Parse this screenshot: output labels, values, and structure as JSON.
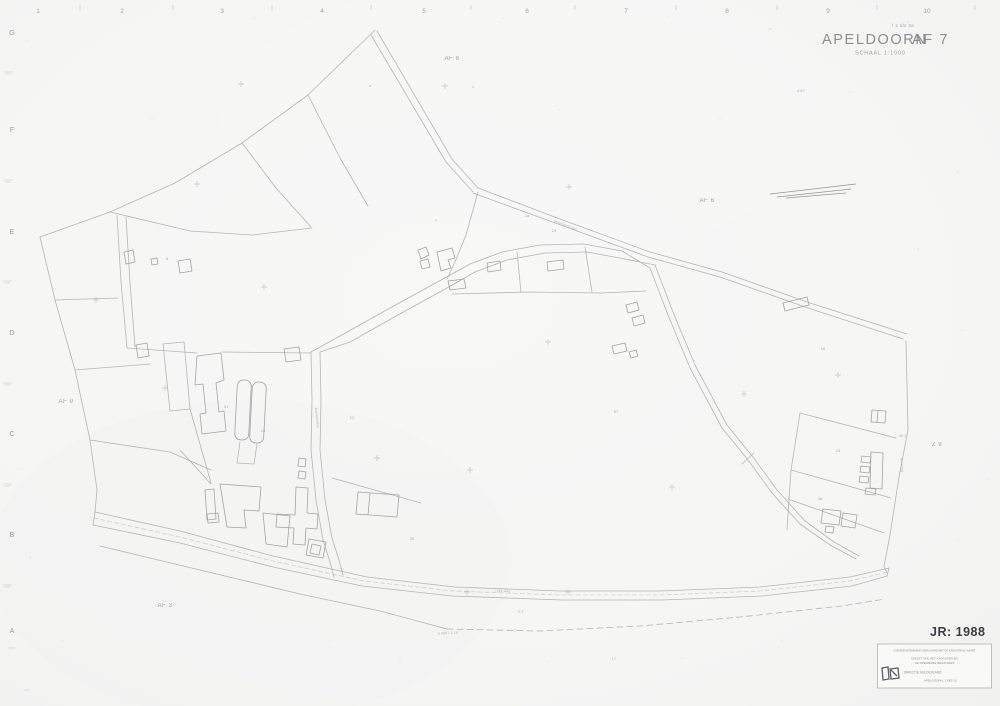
{
  "title_block": {
    "annotation": "f 1 als 3a",
    "city": "APELDOORN",
    "code": "AF 7",
    "scale": "SCHAAL  1:1000",
    "year": "JR: 1988"
  },
  "grid": {
    "top_numbers": [
      {
        "t": "1",
        "x": 38
      },
      {
        "t": "2",
        "x": 122
      },
      {
        "t": "3",
        "x": 222
      },
      {
        "t": "4",
        "x": 322
      },
      {
        "t": "5",
        "x": 424
      },
      {
        "t": "6",
        "x": 527
      },
      {
        "t": "7",
        "x": 626
      },
      {
        "t": "8",
        "x": 727
      },
      {
        "t": "9",
        "x": 828
      },
      {
        "t": "10",
        "x": 927
      }
    ],
    "left_letters": [
      {
        "t": "G",
        "y": 35
      },
      {
        "t": "F",
        "y": 132
      },
      {
        "t": "E",
        "y": 234
      },
      {
        "t": "D",
        "y": 335
      },
      {
        "t": "C",
        "y": 436
      },
      {
        "t": "B",
        "y": 537
      },
      {
        "t": "A",
        "y": 633
      }
    ]
  },
  "sheet_labels": [
    {
      "t": "AF 8",
      "x": 452,
      "y": 60
    },
    {
      "t": "AF 6",
      "x": 707,
      "y": 202
    },
    {
      "t": "AF 9",
      "x": 66,
      "y": 403
    },
    {
      "t": "AF 3",
      "x": 165,
      "y": 607
    },
    {
      "t": "Z 9",
      "x": 937,
      "y": 446
    }
  ],
  "parcel_numbers": [
    {
      "t": "4",
      "x": 370,
      "y": 87
    },
    {
      "t": "1",
      "x": 473,
      "y": 88
    },
    {
      "t": "7",
      "x": 436,
      "y": 222
    },
    {
      "t": "1a",
      "x": 527,
      "y": 217
    },
    {
      "t": "29",
      "x": 554,
      "y": 232
    },
    {
      "t": "18",
      "x": 823,
      "y": 350
    },
    {
      "t": "23",
      "x": 838,
      "y": 452
    },
    {
      "t": "4a",
      "x": 820,
      "y": 500
    },
    {
      "t": "31",
      "x": 226,
      "y": 408
    },
    {
      "t": "12",
      "x": 352,
      "y": 419
    },
    {
      "t": "57",
      "x": 616,
      "y": 413
    },
    {
      "t": "19",
      "x": 263,
      "y": 432
    },
    {
      "t": "26",
      "x": 412,
      "y": 540
    },
    {
      "t": "8",
      "x": 167,
      "y": 260
    }
  ],
  "micro_labels": [
    {
      "t": "deventerstraat",
      "x": 565,
      "y": 226,
      "r": 21
    },
    {
      "t": "barnewinkel",
      "x": 316,
      "y": 418,
      "r": 84
    },
    {
      "t": "wetering",
      "x": 901,
      "y": 465,
      "r": 86
    },
    {
      "t": "rijks weg",
      "x": 503,
      "y": 592,
      "r": 1
    },
    {
      "t": "a 2607  1 10",
      "x": 448,
      "y": 634,
      "r": -2
    },
    {
      "t": "2.2",
      "x": 521,
      "y": 613,
      "r": 0
    },
    {
      "t": "4.80",
      "x": 801,
      "y": 92,
      "r": 0
    },
    {
      "t": "40.1",
      "x": 903,
      "y": 437,
      "r": 0
    },
    {
      "t": "17",
      "x": 614,
      "y": 660,
      "r": 0
    }
  ],
  "stamp": {
    "header": "OVEREENSTEMMEND VERKLAARD MET DE KADASTRALE KAART",
    "line1": "DIENST VAN HET KADASTER EN",
    "line2": "DE OPENBARE REGISTERS",
    "org": "DIRECTIE  GELDERLAND",
    "date": "APELDOORN,  1 MEI  19"
  },
  "colors": {
    "paper": "#f5f5f4",
    "map_line": "#b5b5b8",
    "building_line": "#a3a3a7",
    "title_ink": "#8e8e92",
    "year_ink": "#3d3d41",
    "stamp_ink": "#707075"
  }
}
